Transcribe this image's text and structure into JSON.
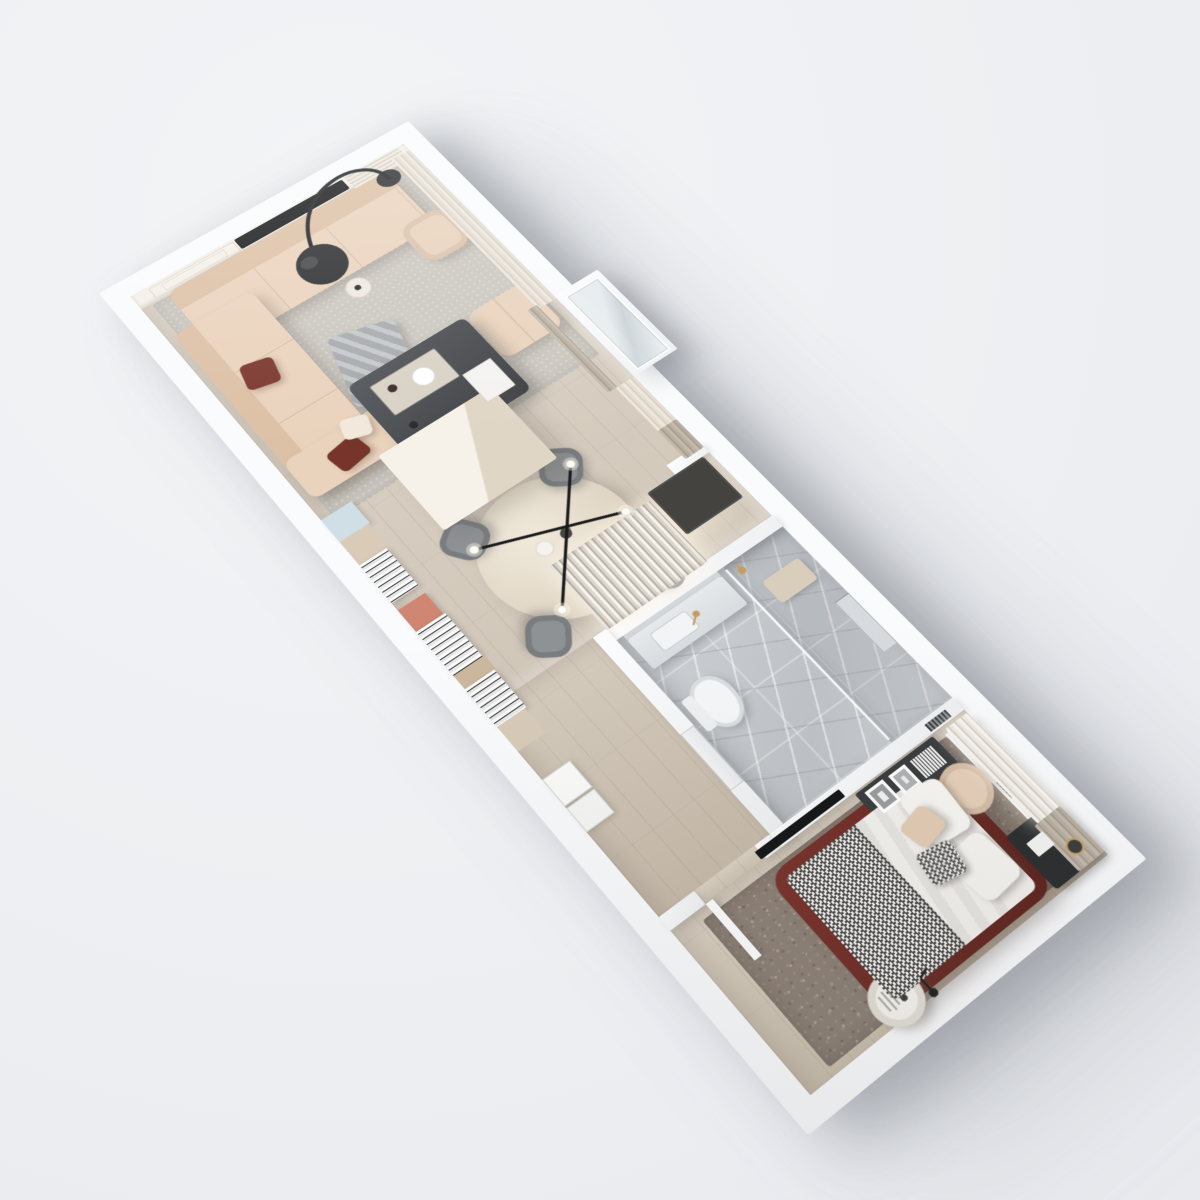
{
  "scene": {
    "title": "3D axonometric floor plan render of a one-bedroom apartment",
    "style": "photorealistic architectural visualization viewed from above, plan rotated diagonally on a plain light background",
    "background_color": "#edeff2",
    "wall_color": "#fafbfd",
    "rooms": [
      {
        "name": "living-room",
        "floor": "light oak parquet with gray area rug",
        "items": [
          {
            "name": "corner-sofa",
            "color": "#ead3bd",
            "detail": "L-shaped beige fabric sofa with two burgundy pillows, one white pillow and a gray throw blanket"
          },
          {
            "name": "coffee-table",
            "color": "#46484b",
            "detail": "dark square table with wooden tray, bottle, white plate, candle and two white books"
          },
          {
            "name": "arc-floor-lamp",
            "color": "#2a2c2e",
            "detail": "black arched lamp with large sphere shade"
          },
          {
            "name": "tv-media-wall",
            "color": "#f4f0e9",
            "detail": "paneled wall with recessed black TV and shelf"
          },
          {
            "name": "ottoman",
            "color": "#e9d3bd"
          },
          {
            "name": "armchair",
            "color": "#e8d2bc"
          },
          {
            "name": "side-stool",
            "color": "#efe9e0"
          },
          {
            "name": "window-curtains",
            "color": "#e4ddd1"
          }
        ]
      },
      {
        "name": "kitchen-dining",
        "floor": "light oak parquet",
        "items": [
          {
            "name": "round-dining-table",
            "color": "#e7dfd1",
            "detail": "cream round table with cup and dark vase with green sprig"
          },
          {
            "name": "dining-chairs",
            "count": 4,
            "color": "#8f9295"
          },
          {
            "name": "pendant-lamp",
            "color": "#1d1e20",
            "detail": "black crossed rods with four white globe bulbs"
          },
          {
            "name": "tall-cabinet",
            "color": "#f6f2ea"
          },
          {
            "name": "wall-shelf-run",
            "detail": "stacked books, pale blue tray, terracotta box, beige boxes along the wall"
          },
          {
            "name": "balcony-glass-bay",
            "color": "#dfe6ea"
          }
        ]
      },
      {
        "name": "entry-hall",
        "floor": "light oak parquet",
        "items": [
          {
            "name": "lit-wardrobe",
            "detail": "open closet with hanging clothes and warm interior lighting"
          },
          {
            "name": "door-mat",
            "color": "#454340"
          },
          {
            "name": "storage-boxes",
            "color": "#fbfbfa"
          }
        ]
      },
      {
        "name": "bathroom",
        "floor": "gray marble tile",
        "items": [
          {
            "name": "vanity-counter",
            "color": "#e6e9eb",
            "detail": "basin with brass faucet and mirror"
          },
          {
            "name": "toilet",
            "color": "#f5f7f8"
          },
          {
            "name": "walk-in-shower",
            "detail": "glass partition, brass shower head, beige bench, wall niche"
          }
        ]
      },
      {
        "name": "bedroom",
        "floor": "light oak parquet with mottled taupe carpet",
        "items": [
          {
            "name": "double-bed",
            "color": "#6d2d27",
            "detail": "burgundy leather frame, white duvet, houndstooth blanket, white, beige and houndstooth pillows"
          },
          {
            "name": "black-nightstand",
            "color": "#2b2d2f",
            "detail": "with white card and brass cup"
          },
          {
            "name": "window-desk-ledge",
            "color": "#eef0f1",
            "detail": "marble ledge with tissue box, phone and vent grille"
          },
          {
            "name": "accent-chair",
            "color": "#e5cfb9"
          },
          {
            "name": "media-console",
            "color": "#3a3c3e",
            "detail": "dark console with two leaning picture frames and books, wall TV above"
          },
          {
            "name": "round-side-table",
            "color": "#f6f4f0"
          },
          {
            "name": "small-floor-lamp",
            "color": "#222222"
          },
          {
            "name": "sheer-curtains",
            "color": "#f8f6f2"
          },
          {
            "name": "gray-curtain",
            "color": "#b7b0a7"
          }
        ]
      }
    ],
    "palette": {
      "background": "#edeff2",
      "walls": "#fafbfd",
      "wood_floor": "#d3c8b7",
      "marble": "#c6cacd",
      "sofa_beige": "#ead3bd",
      "burgundy": "#7c382f",
      "carpet_taupe": "#8d8177",
      "charcoal": "#2b2d2f",
      "brass": "#c8a56b"
    }
  }
}
